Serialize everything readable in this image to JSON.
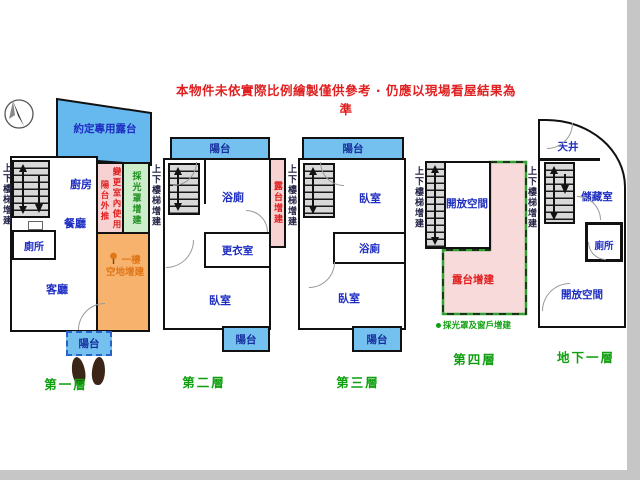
{
  "title": "本物件未依實際比例繪製僅供參考 · 仍應以現場看屋結果為準",
  "floor1": {
    "name": "第一層",
    "stair_note": "上下樓梯增建",
    "terrace": "約定專用露台",
    "kitchen": "廚房",
    "dining": "餐廳",
    "toilet": "廁所",
    "living": "客廳",
    "balcony": "陽台",
    "note_balcony_out": "陽台外推",
    "note_interior_use": "變更室內使用",
    "note_skylight": "採光罩增建",
    "note_ground_line1": "一樓",
    "note_ground_line2": "空地增建"
  },
  "floor2": {
    "name": "第二層",
    "stair_note": "上下樓梯增建",
    "balcony_top": "陽台",
    "bath": "浴廁",
    "note_terrace": "露台增建",
    "closet": "更衣室",
    "bedroom": "臥室",
    "balcony_bottom": "陽台"
  },
  "floor3": {
    "name": "第三層",
    "stair_note": "上下樓梯增建",
    "balcony_top": "陽台",
    "bedroom_top": "臥室",
    "bath": "浴廁",
    "bedroom_bottom": "臥室",
    "balcony_bottom": "陽台"
  },
  "floor4": {
    "name": "第四層",
    "stair_note": "上下樓梯增建",
    "open_space": "開放空間",
    "note_terrace": "露台增建",
    "note_skylight": "採光罩及窗戶增建"
  },
  "floor5": {
    "name": "地下一層",
    "stair_note": "上下樓梯增建",
    "lightwell": "天井",
    "storage": "儲藏室",
    "toilet": "廁所",
    "open_space": "開放空間"
  },
  "colors": {
    "wall": "#111111",
    "balcony_blue": "#74c0ee",
    "annotation_pink": "#f7d2d2",
    "annotation_green": "#cdedcb",
    "annotation_orange": "#f7b26e",
    "stair_gray": "#d9d9d9",
    "room_label_blue": "#1f2ec2",
    "warning_red": "#e02020",
    "floor_label_green": "#0f9f0f",
    "ground_note_orange": "#e07818"
  }
}
